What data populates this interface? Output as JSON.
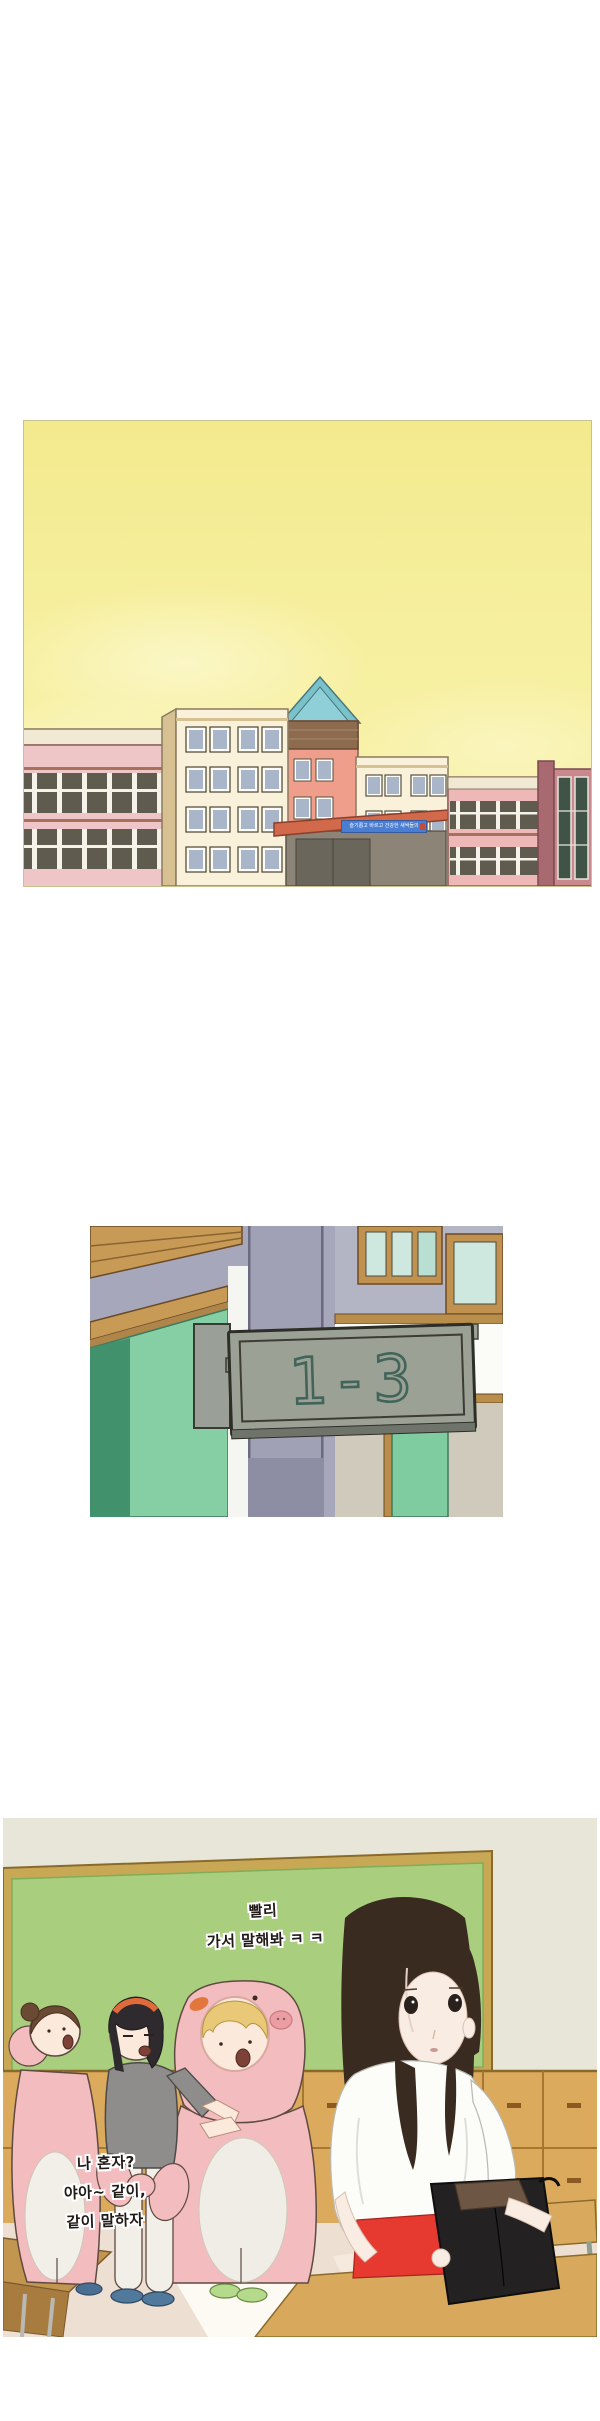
{
  "comic": {
    "panel1": {
      "name": "school-exterior",
      "banner_text": "슬기롭고 바르고 건강한 새싹들의",
      "colors": {
        "sky": "#f6ef9e",
        "sky_light": "#fbf7c6",
        "panel_border": "#c9c28f",
        "building_pink": "#efc6c8",
        "building_cream": "#f9f1da",
        "building_salmon": "#ee9e8b",
        "roof_teal": "#7bc1ca",
        "banner_blue": "#4a7ed2",
        "canopy_orange": "#d2694b"
      }
    },
    "panel2": {
      "name": "hallway-classroom-sign",
      "sign_text": "1-3",
      "colors": {
        "wall_lavender": "#a6a7ba",
        "sign_plate": "#9ba295",
        "sign_digits": "#42645a",
        "door_green": "#86cfa4",
        "wood_trim": "#c79a55"
      }
    },
    "panel3": {
      "name": "classroom-scene",
      "speech_teaser": {
        "line1": "빨리",
        "line2": "가서 말해봐 ㅋ ㅋ"
      },
      "speech_reply": {
        "line1": "나 혼자?",
        "line2": "야아~ 같이,",
        "line3": "같이 말하자"
      },
      "colors": {
        "wall": "#e7e6d8",
        "chalkboard": "#a9ce7e",
        "board_frame": "#c9a855",
        "cabinets": "#dcaa5d",
        "floor": "#eedfd3",
        "pig_costume_pink": "#f3bcbf",
        "skirt_red": "#e63a30",
        "paper_bag_black": "#232122"
      }
    }
  }
}
